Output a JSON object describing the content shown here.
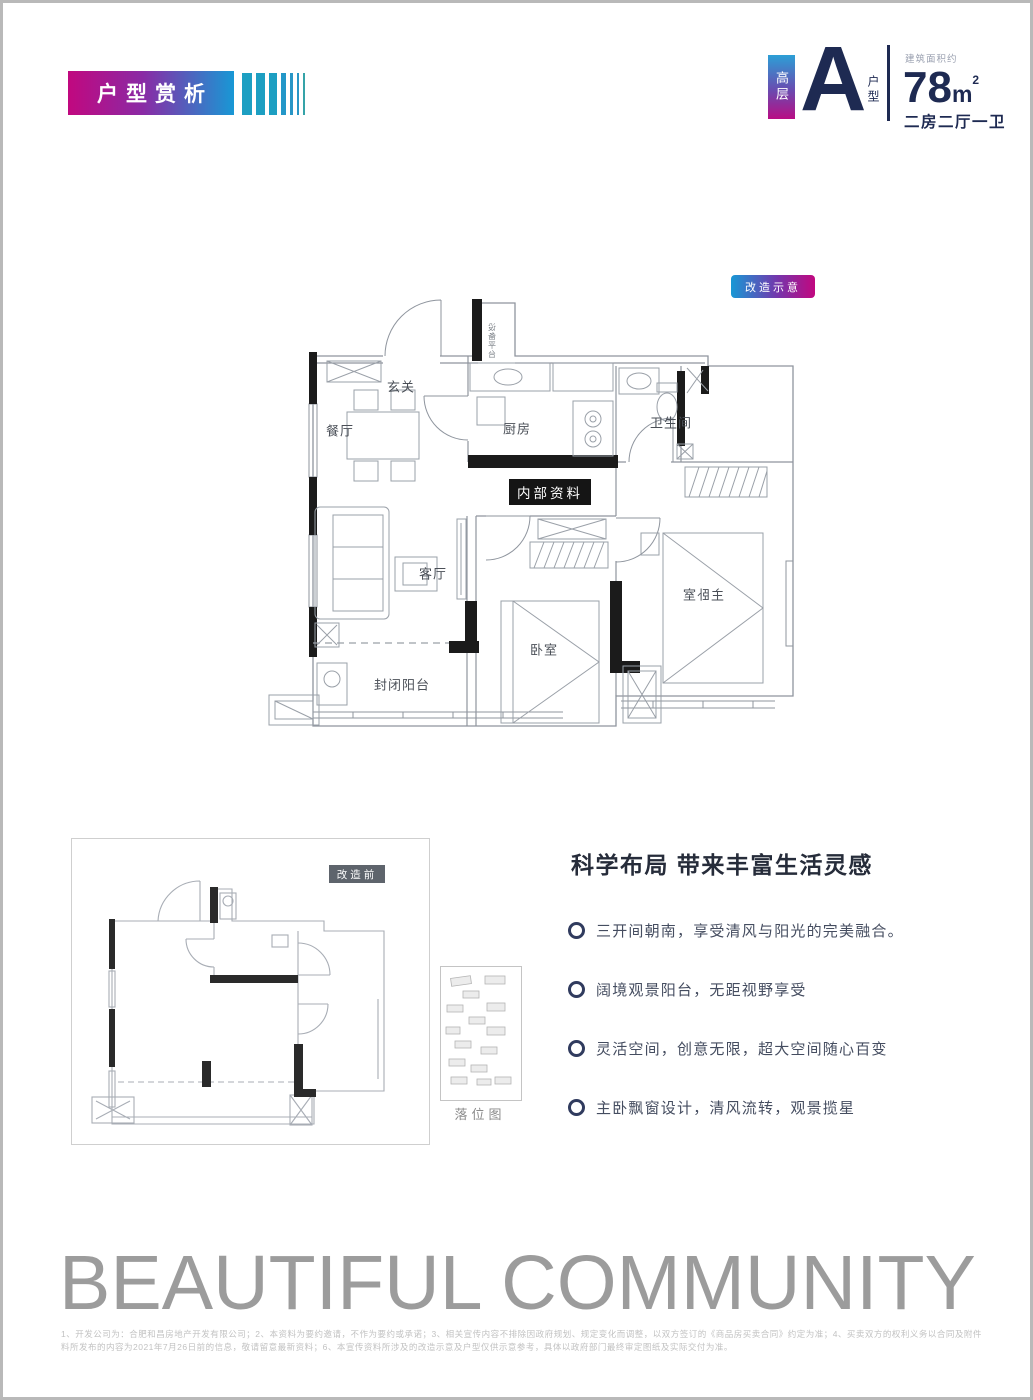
{
  "header": {
    "badge_label": "户型赏析",
    "unit": {
      "tier": "高层",
      "letter": "A",
      "letter_suffix": "户型",
      "area_caption": "建筑面积约",
      "area_value": "78",
      "area_unit": "m",
      "area_sup": "2",
      "layout": "二房二厅一卫"
    }
  },
  "main_plan": {
    "badge": "改造示意",
    "watermark": "内部资料",
    "rooms": {
      "entry": "玄关",
      "dining": "餐厅",
      "kitchen": "厨房",
      "bath": "卫生间",
      "living": "客厅",
      "bedroom": "卧室",
      "master": "主卧室",
      "balcony": "封闭阳台",
      "shaft": "设备平台"
    }
  },
  "before_plan": {
    "badge": "改造前"
  },
  "site_map": {
    "caption": "落位图"
  },
  "features": {
    "heading": "科学布局 带来丰富生活灵感",
    "items": [
      "三开间朝南，享受清风与阳光的完美融合。",
      "阔境观景阳台，无距视野享受",
      "灵活空间，创意无限，超大空间随心百变",
      "主卧飘窗设计，清风流转，观景揽星"
    ]
  },
  "footer": {
    "slogan": "BEAUTIFUL COMMUNITY",
    "disclaimer": [
      "1、开发公司为：合肥和昌房地产开发有限公司；2、本资料为要约邀请，不作为要约或承诺；3、相关宣传内容不排除因政府规划、规定变化而调整，以双方签订的《商品房买卖合同》约定为准；4、买卖双方的权利义务以合同及附件为准；5、本资",
      "料所发布的内容为2021年7月26日前的信息，敬请留意最新资料；6、本宣传资料所涉及的改造示意及户型仅供示意参考，具体以政府部门最终审定图纸及实际交付为准。"
    ]
  },
  "colors": {
    "magenta": "#C1087F",
    "blue": "#1898D5",
    "teal_bar": "#1D9FC2",
    "navy": "#1E2A52",
    "wall_black": "#1B1B1B",
    "plan_line": "#8F959E",
    "slogan_gray": "#9C9C9C"
  }
}
